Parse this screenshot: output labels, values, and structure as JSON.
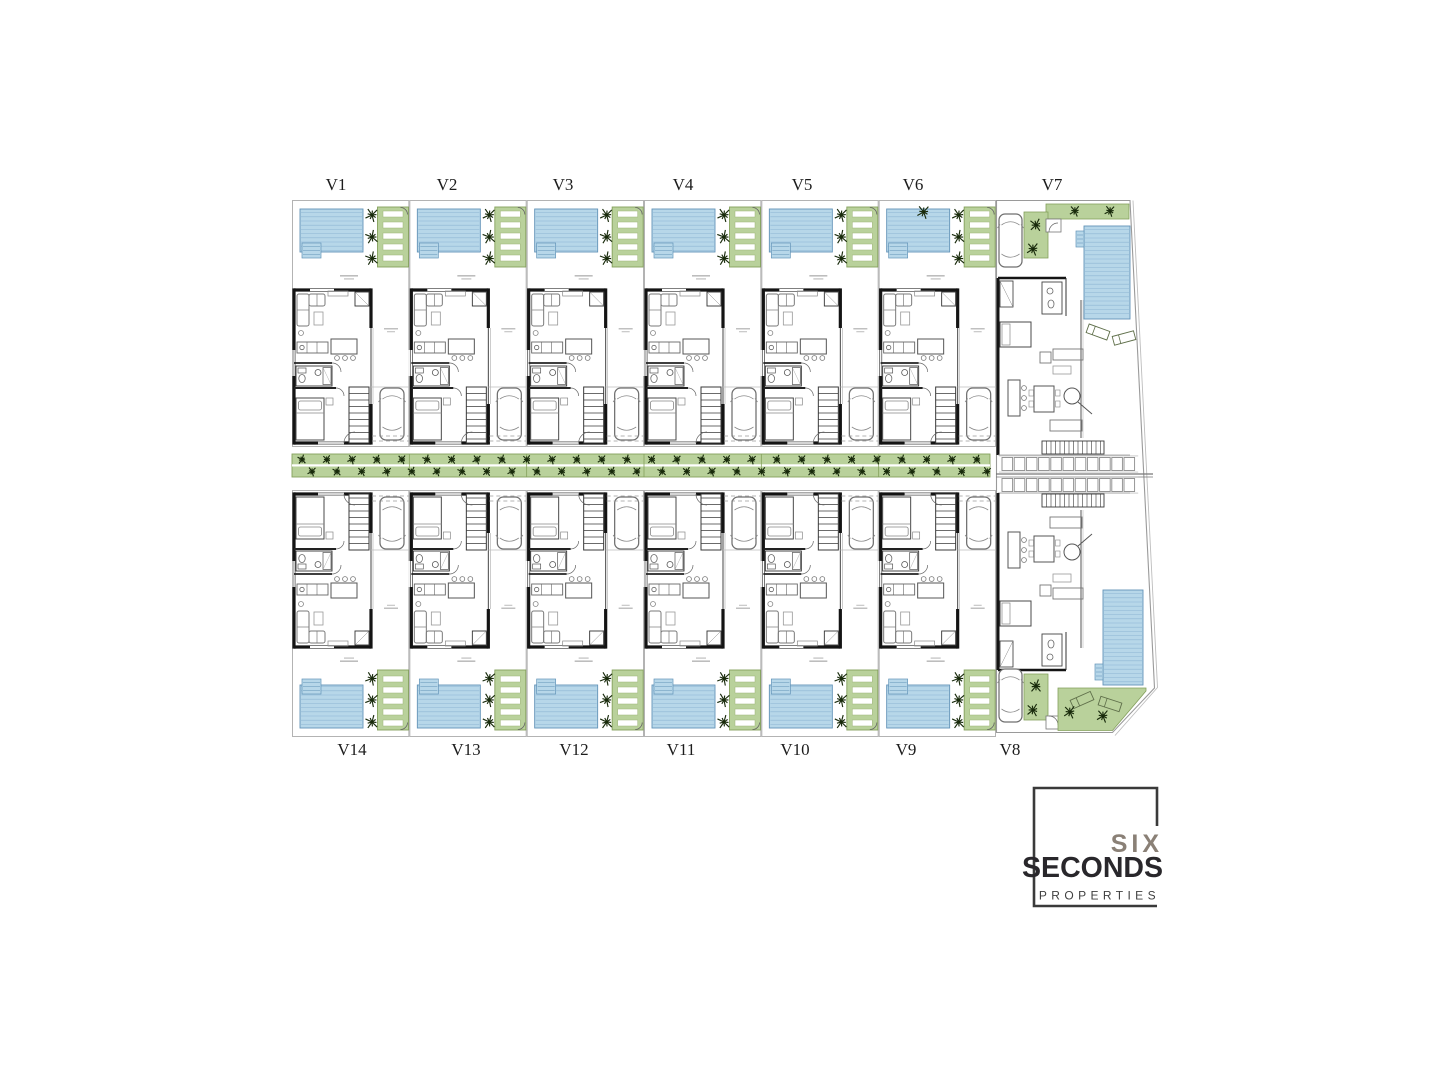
{
  "plan": {
    "top_units": [
      {
        "label": "V1"
      },
      {
        "label": "V2"
      },
      {
        "label": "V3"
      },
      {
        "label": "V4"
      },
      {
        "label": "V5"
      },
      {
        "label": "V6"
      },
      {
        "label": "V7"
      }
    ],
    "bottom_units": [
      {
        "label": "V14"
      },
      {
        "label": "V13"
      },
      {
        "label": "V12"
      },
      {
        "label": "V11"
      },
      {
        "label": "V10"
      },
      {
        "label": "V9"
      },
      {
        "label": "V8"
      }
    ]
  },
  "logo": {
    "six": "SIX",
    "seconds": "SECONDS",
    "properties": "PROPERTIES"
  },
  "colors": {
    "pool": "#b7d7e9",
    "pool_stripe": "#8cb6d4",
    "pool_border": "#6394b8",
    "green": "#b9d19b",
    "green_border": "#84a05c",
    "slat_border": "#9db377",
    "tree": "#182a0b",
    "wall": "#141414",
    "lot": "#b3b3b3",
    "furn": "#777777",
    "label": "#1c1c1c",
    "logo_frame": "#3a3a3a",
    "logo_six": "#8a8076",
    "logo_seconds": "#29272b",
    "logo_properties": "#3f3f3f"
  }
}
